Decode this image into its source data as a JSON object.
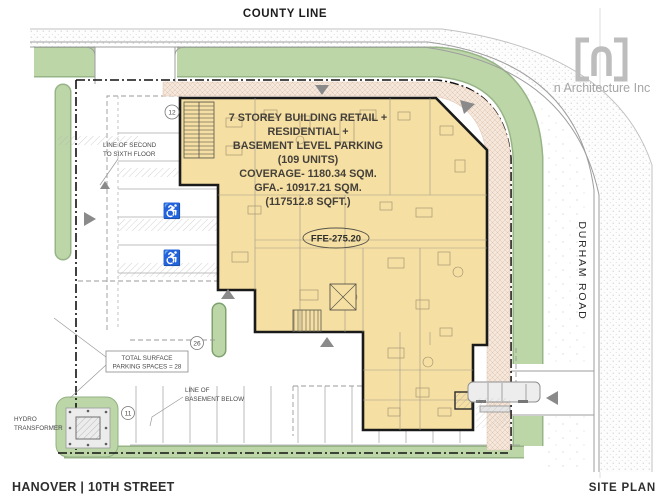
{
  "plan": {
    "roads": {
      "county_line": "COUNTY LINE",
      "durham_road": "DURHAM ROAD"
    },
    "building": {
      "info_lines": [
        "7 STOREY  BUILDING RETAIL +",
        "RESIDENTIAL +",
        "BASEMENT LEVEL PARKING",
        "(109 UNITS)",
        "COVERAGE-  1180.34 SQM.",
        "GFA.- 10917.21 SQM.",
        "(117512.8 SQFT.)"
      ],
      "ffe_label": "FFE-275.20"
    },
    "annotations": {
      "second_floor_line_1": "LINE OF  SECOND",
      "second_floor_line_2": "TO SIXTH FLOOR",
      "surface_parking_line_1": "TOTAL SURFACE",
      "surface_parking_line_2": "PARKING SPACES = 28",
      "basement_line_1": "LINE OF",
      "basement_line_2": "BASEMENT BELOW",
      "hydro_line_1": "HYDRO",
      "hydro_line_2": "TRANSFORMER"
    },
    "markers": {
      "north_count": "12",
      "mid_count": "26",
      "south_count": "11"
    },
    "symbols": {
      "accessible": "♿"
    }
  },
  "titleblock": {
    "project": "HANOVER | 10TH STREET",
    "sheet": "SITE PLAN"
  },
  "logo": {
    "company": "n Architecture Inc"
  },
  "colors": {
    "building_fill": "#F6DFA2",
    "landscape_green": "#BCD6A8",
    "walkway_pink": "#F5E7DB",
    "line_black": "#1A1A1A"
  }
}
